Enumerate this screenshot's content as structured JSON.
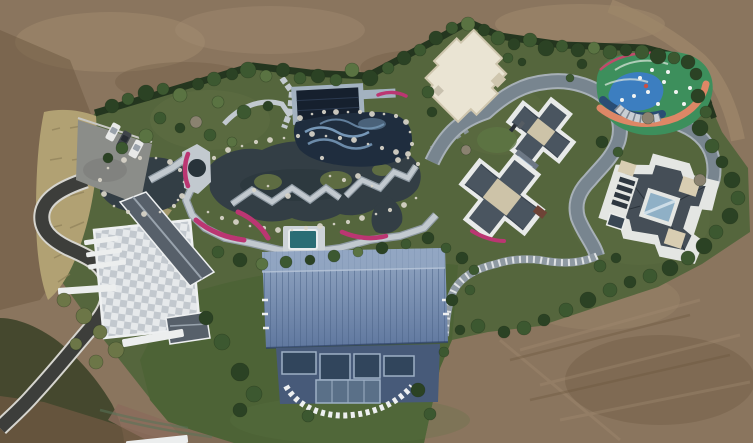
{
  "palette": {
    "dirt": "#8a755e",
    "dirt_light": "#a38d72",
    "dirt_dark": "#6b573f",
    "dirt_track": "#9c8669",
    "dirt_pink": "#8a6c5c",
    "estate": "#55663d",
    "lawn": "#4d6336",
    "lawn_light": "#5d7544",
    "garden": "#5e6c42",
    "hedge": "#24361f",
    "scrub": "#45482e",
    "dry_grass": "#b1a173",
    "dry_grass_dark": "#8f815a",
    "canopy_dark": "#2b4224",
    "canopy_mid": "#3c5830",
    "canopy_light": "#5a7342",
    "canopy_olive": "#6c7647",
    "canopy_bare": "#8a8270",
    "pond": "#333e45",
    "pond_deep": "#28333a",
    "path": "#c2c9cf",
    "path_edge": "#8f9aa3",
    "road": "#78858f",
    "road_light": "#a7b0b7",
    "asphalt": "#3d3e3b",
    "asphalt_edge": "#d6d5cf",
    "parking": "#8b8d89",
    "terrace_a": "#e6e9eb",
    "terrace_b": "#c2c8ce",
    "roof_slate": "#57606a",
    "roof_ridge": "#99a3ad",
    "trim": "#eef0f1",
    "barn_top": "#93a7c3",
    "barn_mid": "#60789f",
    "barn_seam": "#4a6186",
    "barn_facade": "#475a79",
    "barn_glass": "#31455c",
    "barn_glass_frame": "#9db0c5",
    "navy": "#16202e",
    "pav_frame": "#a3b2c0",
    "pool_tile": "#7fa3c4",
    "pool_dark": "#1f2d3e",
    "teal_pool": "#2a6d75",
    "white_roof": "#eae4d3",
    "white_roof_shade": "#cfc6ae",
    "g2_roof": "#4a5560",
    "g2_plateau": "#cdc3a8",
    "g2_glass": "#a9c0d6",
    "g2_white": "#e8eae9",
    "g3_white": "#e4e6e3",
    "g3_roof": "#454e57",
    "g3_glass": "#8fb0c6",
    "g3_cream": "#d8cdb2",
    "g3_louver": "#2e3740",
    "pg_green": "#3d8f5c",
    "pg_blue": "#3c7ec0",
    "pg_orange": "#dd8766",
    "pg_navy": "#2a4d74",
    "pg_rim": "#c04a6a",
    "canopy_gray": "#c9ced3",
    "flower": "#bb3672",
    "rock": "#d9d5c9",
    "car_white": "#e8e9e8",
    "car_gray": "#3f444a"
  },
  "scene": {
    "trees": [
      [
        112,
        106,
        7,
        "d"
      ],
      [
        128,
        99,
        6,
        "m"
      ],
      [
        146,
        93,
        8,
        "d"
      ],
      [
        163,
        89,
        6,
        "m"
      ],
      [
        180,
        95,
        7,
        "l"
      ],
      [
        198,
        84,
        6,
        "d"
      ],
      [
        214,
        79,
        7,
        "m"
      ],
      [
        232,
        74,
        6,
        "d"
      ],
      [
        248,
        70,
        8,
        "m"
      ],
      [
        266,
        76,
        6,
        "l"
      ],
      [
        283,
        70,
        7,
        "d"
      ],
      [
        300,
        78,
        6,
        "m"
      ],
      [
        318,
        76,
        7,
        "d"
      ],
      [
        336,
        80,
        6,
        "m"
      ],
      [
        352,
        70,
        7,
        "l"
      ],
      [
        370,
        78,
        8,
        "d"
      ],
      [
        388,
        68,
        6,
        "m"
      ],
      [
        404,
        58,
        7,
        "d"
      ],
      [
        420,
        50,
        6,
        "m"
      ],
      [
        436,
        38,
        7,
        "d"
      ],
      [
        452,
        28,
        6,
        "m"
      ],
      [
        468,
        24,
        7,
        "l"
      ],
      [
        484,
        30,
        6,
        "d"
      ],
      [
        498,
        38,
        7,
        "m"
      ],
      [
        514,
        44,
        6,
        "d"
      ],
      [
        530,
        40,
        7,
        "m"
      ],
      [
        546,
        48,
        8,
        "d"
      ],
      [
        562,
        46,
        6,
        "m"
      ],
      [
        578,
        50,
        7,
        "d"
      ],
      [
        594,
        48,
        6,
        "l"
      ],
      [
        610,
        52,
        7,
        "m"
      ],
      [
        626,
        50,
        6,
        "d"
      ],
      [
        642,
        52,
        7,
        "m"
      ],
      [
        658,
        56,
        8,
        "d"
      ],
      [
        674,
        58,
        6,
        "m"
      ],
      [
        688,
        62,
        7,
        "d"
      ],
      [
        698,
        96,
        7,
        "d"
      ],
      [
        706,
        112,
        6,
        "m"
      ],
      [
        700,
        128,
        8,
        "d"
      ],
      [
        712,
        146,
        7,
        "m"
      ],
      [
        722,
        162,
        6,
        "d"
      ],
      [
        732,
        180,
        8,
        "d"
      ],
      [
        738,
        198,
        7,
        "m"
      ],
      [
        730,
        216,
        8,
        "d"
      ],
      [
        716,
        232,
        7,
        "m"
      ],
      [
        704,
        246,
        8,
        "d"
      ],
      [
        688,
        258,
        7,
        "m"
      ],
      [
        670,
        268,
        8,
        "d"
      ],
      [
        650,
        276,
        7,
        "m"
      ],
      [
        630,
        282,
        6,
        "d"
      ],
      [
        610,
        290,
        7,
        "m"
      ],
      [
        588,
        300,
        8,
        "d"
      ],
      [
        566,
        310,
        7,
        "m"
      ],
      [
        544,
        320,
        6,
        "d"
      ],
      [
        524,
        328,
        7,
        "m"
      ],
      [
        504,
        332,
        6,
        "d"
      ],
      [
        478,
        326,
        7,
        "m"
      ],
      [
        460,
        330,
        5,
        "d"
      ],
      [
        160,
        118,
        6,
        "m"
      ],
      [
        146,
        136,
        7,
        "l"
      ],
      [
        122,
        148,
        6,
        "m"
      ],
      [
        108,
        158,
        5,
        "d"
      ],
      [
        218,
        102,
        6,
        "l"
      ],
      [
        244,
        112,
        7,
        "m"
      ],
      [
        268,
        106,
        5,
        "d"
      ],
      [
        210,
        135,
        6,
        "m"
      ],
      [
        232,
        142,
        5,
        "l"
      ],
      [
        180,
        128,
        5,
        "d"
      ],
      [
        196,
        122,
        6,
        "b"
      ],
      [
        218,
        252,
        6,
        "m"
      ],
      [
        240,
        260,
        7,
        "d"
      ],
      [
        262,
        264,
        6,
        "l"
      ],
      [
        286,
        262,
        6,
        "m"
      ],
      [
        310,
        260,
        5,
        "d"
      ],
      [
        334,
        256,
        6,
        "m"
      ],
      [
        358,
        252,
        5,
        "l"
      ],
      [
        382,
        248,
        6,
        "d"
      ],
      [
        406,
        244,
        5,
        "m"
      ],
      [
        428,
        238,
        6,
        "d"
      ],
      [
        446,
        248,
        5,
        "m"
      ],
      [
        462,
        258,
        6,
        "d"
      ],
      [
        474,
        270,
        5,
        "m"
      ],
      [
        206,
        318,
        7,
        "d"
      ],
      [
        222,
        342,
        8,
        "m"
      ],
      [
        240,
        372,
        9,
        "d"
      ],
      [
        254,
        394,
        8,
        "m"
      ],
      [
        240,
        410,
        7,
        "d"
      ],
      [
        308,
        416,
        6,
        "m"
      ],
      [
        418,
        390,
        7,
        "d"
      ],
      [
        430,
        414,
        6,
        "m"
      ],
      [
        444,
        352,
        5,
        "m"
      ],
      [
        452,
        300,
        6,
        "d"
      ],
      [
        470,
        290,
        5,
        "m"
      ],
      [
        428,
        92,
        6,
        "m"
      ],
      [
        432,
        112,
        5,
        "d"
      ],
      [
        508,
        58,
        5,
        "m"
      ],
      [
        522,
        62,
        4,
        "d"
      ],
      [
        466,
        150,
        5,
        "b"
      ],
      [
        602,
        142,
        6,
        "d"
      ],
      [
        618,
        152,
        5,
        "m"
      ],
      [
        582,
        64,
        5,
        "d"
      ],
      [
        570,
        78,
        4,
        "m"
      ],
      [
        696,
        74,
        6,
        "d"
      ],
      [
        648,
        118,
        6,
        "b"
      ],
      [
        700,
        180,
        6,
        "b"
      ],
      [
        600,
        266,
        6,
        "m"
      ],
      [
        616,
        258,
        5,
        "d"
      ],
      [
        64,
        300,
        7,
        "o"
      ],
      [
        84,
        316,
        8,
        "o"
      ],
      [
        100,
        332,
        7,
        "o"
      ],
      [
        116,
        350,
        8,
        "o"
      ],
      [
        96,
        362,
        7,
        "o"
      ],
      [
        76,
        344,
        6,
        "o"
      ]
    ],
    "rocks": [
      [
        208,
        212
      ],
      [
        222,
        218
      ],
      [
        236,
        222
      ],
      [
        250,
        226
      ],
      [
        264,
        228
      ],
      [
        278,
        230
      ],
      [
        292,
        230
      ],
      [
        306,
        228
      ],
      [
        320,
        226
      ],
      [
        334,
        224
      ],
      [
        348,
        222
      ],
      [
        362,
        218
      ],
      [
        376,
        214
      ],
      [
        390,
        210
      ],
      [
        404,
        205
      ],
      [
        416,
        198
      ],
      [
        214,
        158
      ],
      [
        228,
        150
      ],
      [
        242,
        146
      ],
      [
        256,
        142
      ],
      [
        270,
        140
      ],
      [
        284,
        138
      ],
      [
        298,
        136
      ],
      [
        312,
        134
      ],
      [
        326,
        136
      ],
      [
        340,
        138
      ],
      [
        354,
        140
      ],
      [
        368,
        144
      ],
      [
        382,
        148
      ],
      [
        396,
        152
      ],
      [
        408,
        158
      ],
      [
        418,
        164
      ],
      [
        300,
        118
      ],
      [
        312,
        114
      ],
      [
        324,
        112
      ],
      [
        336,
        112
      ],
      [
        348,
        112
      ],
      [
        360,
        112
      ],
      [
        372,
        114
      ],
      [
        384,
        114
      ],
      [
        396,
        116
      ],
      [
        406,
        122
      ],
      [
        410,
        132
      ],
      [
        412,
        144
      ],
      [
        408,
        154
      ],
      [
        330,
        176
      ],
      [
        344,
        180
      ],
      [
        358,
        176
      ],
      [
        268,
        186
      ],
      [
        254,
        190
      ],
      [
        288,
        196
      ],
      [
        372,
        186
      ],
      [
        322,
        158
      ],
      [
        398,
        160
      ],
      [
        108,
        168
      ],
      [
        100,
        180
      ],
      [
        104,
        194
      ],
      [
        114,
        206
      ],
      [
        128,
        212
      ],
      [
        144,
        214
      ],
      [
        160,
        212
      ],
      [
        174,
        206
      ],
      [
        182,
        196
      ],
      [
        184,
        182
      ],
      [
        180,
        170
      ],
      [
        170,
        162
      ],
      [
        156,
        158
      ],
      [
        140,
        158
      ],
      [
        124,
        160
      ],
      [
        178,
        200
      ]
    ],
    "cars": [
      {
        "x": 113,
        "y": 132,
        "rot": 28,
        "c": "car_white"
      },
      {
        "x": 124,
        "y": 140,
        "rot": 28,
        "c": "car_gray"
      },
      {
        "x": 136,
        "y": 149,
        "rot": 28,
        "c": "car_white"
      }
    ],
    "bars": [
      [
        58,
        286,
        58,
        7,
        -4
      ],
      [
        122,
        334,
        62,
        8,
        -10
      ],
      [
        126,
        438,
        62,
        8,
        -6
      ],
      [
        84,
        238,
        34,
        5,
        -8
      ],
      [
        86,
        250,
        36,
        5,
        -8
      ],
      [
        88,
        262,
        38,
        5,
        -8
      ]
    ],
    "playground_dots": [
      [
        640,
        78
      ],
      [
        652,
        70
      ],
      [
        664,
        82
      ],
      [
        676,
        92
      ],
      [
        648,
        92
      ],
      [
        634,
        96
      ],
      [
        668,
        72
      ],
      [
        690,
        88
      ],
      [
        658,
        104
      ],
      [
        622,
        100
      ],
      [
        684,
        104
      ]
    ]
  }
}
